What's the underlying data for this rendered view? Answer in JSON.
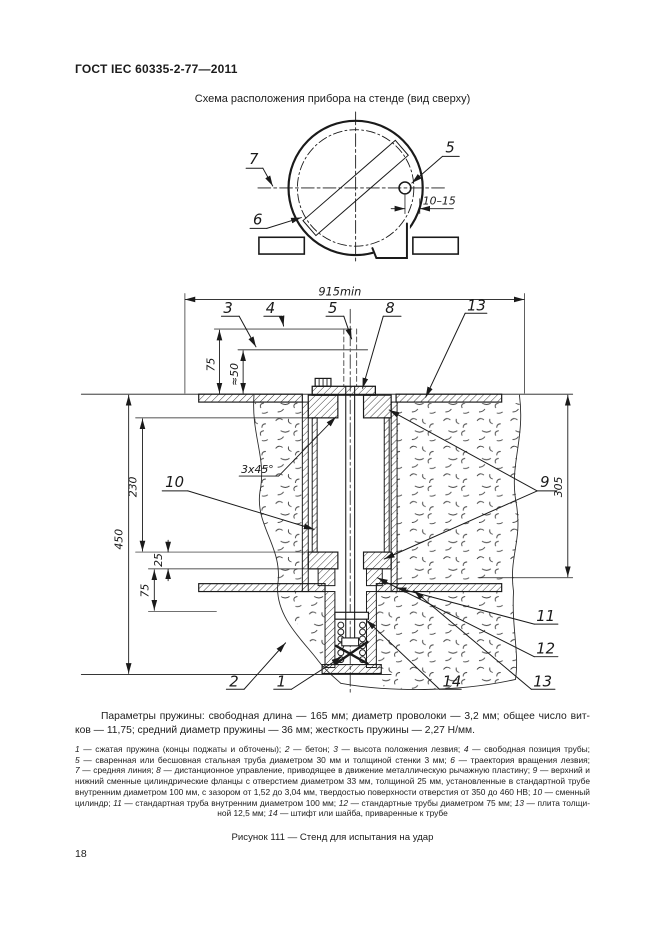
{
  "page": {
    "header": "ГОСТ IEC 60335-2-77—2011",
    "number": "18"
  },
  "figure": {
    "top_view_title": "Схема расположения прибора на стенде (вид сверху)",
    "caption": "Рисунок 111 — Стенд для испытания на удар"
  },
  "top_view": {
    "callouts": {
      "c5": "5",
      "c6": "6",
      "c7": "7"
    },
    "dims": {
      "gap": "10–15"
    }
  },
  "main_view": {
    "callouts": {
      "c1": "1",
      "c2": "2",
      "c3": "3",
      "c4": "4",
      "c5": "5",
      "c8": "8",
      "c9": "9",
      "c10": "10",
      "c11": "11",
      "c12": "12",
      "c13_top": "13",
      "c13_bottom": "13",
      "c14": "14"
    },
    "dims": {
      "width": "915min",
      "blade_h": "75",
      "blade_h2": "≈50",
      "d230": "230",
      "d450": "450",
      "d25": "25",
      "d75": "75",
      "d305": "305",
      "chamfer": "3x45°"
    }
  },
  "spring_note": {
    "line1": "Параметры пружины: свободная длина — 165 мм; диаметр проволоки — 3,2 мм; общее число вит-",
    "line2": "ков — 11,75; средний диаметр пружины — 36 мм; жесткость пружины — 2,27 Н/мм."
  },
  "legend": {
    "lines": [
      [
        {
          "t": "1",
          "i": 1
        },
        {
          "t": " — сжатая пружина (концы поджаты и обточены); "
        },
        {
          "t": "2",
          "i": 1
        },
        {
          "t": " — бетон; "
        },
        {
          "t": "3",
          "i": 1
        },
        {
          "t": " — высота положения лезвия; "
        },
        {
          "t": "4",
          "i": 1
        },
        {
          "t": " — свободная позиция трубы;"
        }
      ],
      [
        {
          "t": "5",
          "i": 1
        },
        {
          "t": " — сваренная или бесшовная стальная труба диаметром 30 мм и толщиной стенки 3 мм; "
        },
        {
          "t": "6",
          "i": 1
        },
        {
          "t": " — траектория вращения лезвия;"
        }
      ],
      [
        {
          "t": "7",
          "i": 1
        },
        {
          "t": " — средняя линия; "
        },
        {
          "t": "8",
          "i": 1
        },
        {
          "t": " — дистанционное управление, приводящее в движение металлическую рычажную пластину; "
        },
        {
          "t": "9",
          "i": 1
        },
        {
          "t": " — верхний и"
        }
      ],
      [
        {
          "t": "нижний сменные цилиндрические фланцы с отверстием диаметром 33 мм, толщиной 25 мм, установленные в стандартной трубе"
        }
      ],
      [
        {
          "t": "внутренним диаметром 100 мм, с зазором от 1,52 до 3,04 мм, твердостью поверхности отверстия от 350 до 460 НВ; "
        },
        {
          "t": "10",
          "i": 1
        },
        {
          "t": " — сменный"
        }
      ],
      [
        {
          "t": "цилиндр; "
        },
        {
          "t": "11",
          "i": 1
        },
        {
          "t": " — стандартная труба внутренним диаметром 100 мм; "
        },
        {
          "t": "12",
          "i": 1
        },
        {
          "t": " — стандартные трубы диаметром 75 мм; "
        },
        {
          "t": "13",
          "i": 1
        },
        {
          "t": " — плита толщи-"
        }
      ],
      [
        {
          "t": "ной 12,5 мм; "
        },
        {
          "t": "14",
          "i": 1
        },
        {
          "t": " — штифт или шайба, приваренные к трубе"
        }
      ]
    ]
  }
}
